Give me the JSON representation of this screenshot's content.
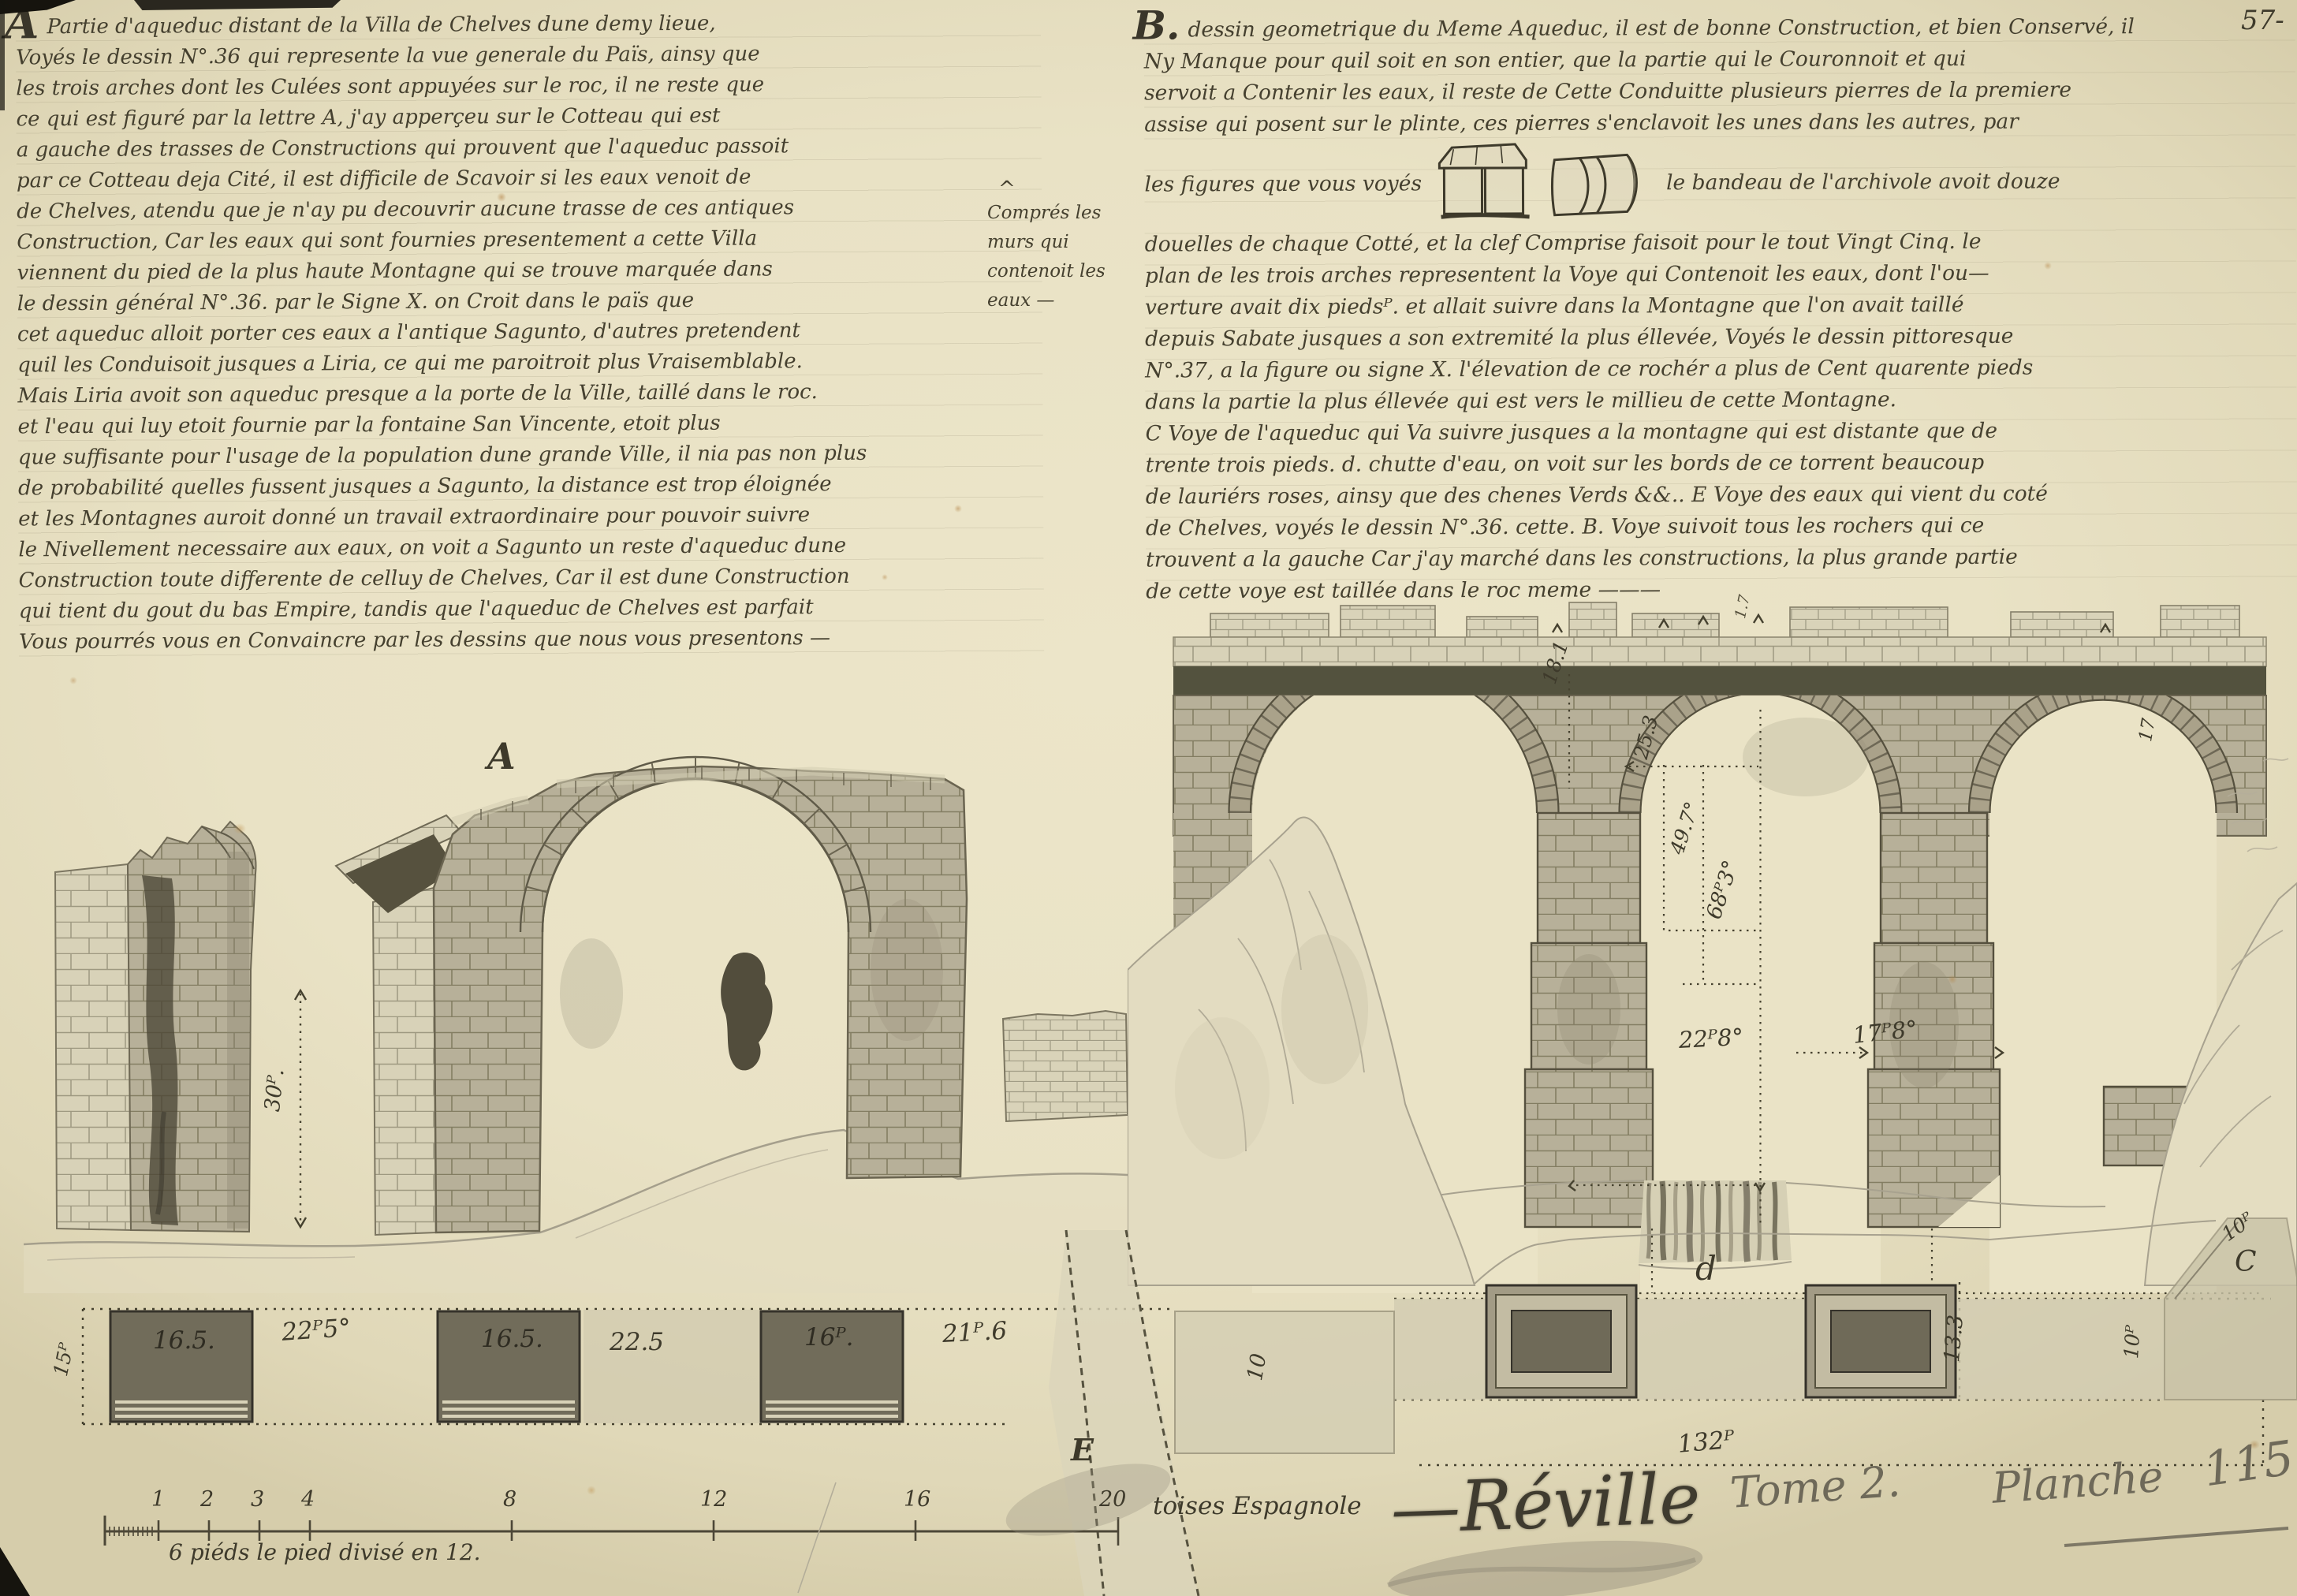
{
  "page": {
    "number": "57-"
  },
  "colors": {
    "paper": "#eae3c6",
    "ink": "#3e3a2b",
    "pencil": "#6e6959",
    "wash_light": "#d8d2b8",
    "wash_mid": "#b7b099",
    "wash_dark": "#53523e"
  },
  "left_text": {
    "initial": "A",
    "lines": [
      "Partie d'aqueduc distant de la Villa de Chelves dune demy lieue,",
      "Voyés le dessin N°.36 qui represente la vue generale du Païs, ainsy que",
      "les trois arches dont les Culées sont appuyées sur le roc, il ne reste que",
      "ce qui est figuré par la lettre A, j'ay apperçeu sur le Cotteau qui est",
      "a gauche des trasses de Constructions qui prouvent que l'aqueduc passoit",
      "par ce Cotteau deja Cité, il est difficile de Scavoir si les eaux venoit de",
      "de Chelves, atendu que je n'ay pu decouvrir aucune trasse de ces antiques",
      "Construction, Car les eaux qui sont fournies presentement a cette Villa",
      "viennent du pied de la plus haute Montagne qui se trouve marquée dans",
      "le dessin général N°.36. par le Signe X. on Croit dans le païs que",
      "cet aqueduc alloit porter ces eaux a l'antique Sagunto, d'autres pretendent",
      "quil les Conduisoit jusques a Liria, ce qui me paroitroit plus Vraisemblable.",
      "Mais Liria avoit son aqueduc presque a la porte de la Ville, taillé dans le roc.",
      "et l'eau qui luy etoit fournie par la fontaine San Vincente, etoit plus",
      "que suffisante pour l'usage de la population dune grande Ville, il nia pas non plus",
      "de probabilité quelles fussent jusques a Sagunto, la distance est trop éloignée",
      "et les Montagnes auroit donné un travail extraordinaire pour pouvoir suivre",
      "le Nivellement necessaire aux eaux, on voit a Sagunto un reste d'aqueduc dune",
      "Construction toute differente de celluy de Chelves, Car il est dune Construction",
      "qui tient du gout du bas Empire, tandis que l'aqueduc de Chelves est parfait",
      "Vous pourrés vous en Convaincre par les dessins que nous vous presentons —"
    ]
  },
  "margin_note": {
    "caret": "^",
    "lines": [
      "Comprés les",
      "murs qui",
      "contenoit les",
      "eaux —"
    ]
  },
  "right_text": {
    "initial": "B.",
    "lines_before": [
      "dessin geometrique du Meme Aqueduc, il est de bonne Construction, et bien Conservé, il",
      "Ny Manque pour quil soit en son entier, que la partie qui le Couronnoit et qui",
      "servoit a Contenir les eaux, il reste de Cette Conduitte plusieurs pierres de la premiere",
      "assise qui posent sur le plinte, ces pierres s'enclavoit les unes dans les autres, par"
    ],
    "fig_prefix": "les figures que vous voyés",
    "fig_suffix": "le bandeau de l'archivole avoit douze",
    "lines_after": [
      "douelles de chaque Cotté, et la clef Comprise faisoit pour le tout Vingt Cinq. le",
      "plan de les trois arches representent la Voye qui Contenoit les eaux, dont l'ou—",
      "verture avait dix piedsᴾ. et allait suivre dans la Montagne que l'on avait taillé",
      "depuis Sabate jusques a son extremité la plus éllevée, Voyés le dessin pittoresque",
      "N°.37, a la figure ou signe X. l'élevation de ce rochér a plus de Cent quarente pieds",
      "dans la partie la plus éllevée qui est vers le millieu de cette Montagne.",
      "C Voye de l'aqueduc qui Va suivre jusques a la montagne qui est distante que de",
      "trente trois pieds.  d. chutte d'eau, on voit sur les bords de ce torrent beaucoup",
      "de lauriérs roses, ainsy que des chenes Verds &&.. E Voye des eaux qui vient du coté",
      "de Chelves, voyés le dessin N°.36. cette.  B.  Voye suivoit tous les rochers qui ce",
      "trouvent a la gauche Car j'ay marché dans les constructions, la plus grande partie",
      "de cette voye est taillée dans le roc meme ———"
    ]
  },
  "drawing_a": {
    "label": "A",
    "dim_height": "30ᴾ."
  },
  "drawing_b": {
    "dim_18_1": "18.1",
    "dim_1_7": "1.7",
    "dim_25_3": "25.3",
    "dim_49_7": "49.7°",
    "dim_68_3": "68ᴾ3°",
    "dim_17": "17",
    "dim_22_8": "22ᴾ8°",
    "dim_17_8": "17ᴾ8°",
    "label_d": "d"
  },
  "plan": {
    "dim_15": "15ᴾ",
    "pier1": "16.5.",
    "gap1": "22ᴾ5°",
    "pier2": "16.5.",
    "gap2": "22.5",
    "pier3": "16ᴾ.",
    "gap3": "21ᴾ.6",
    "label_e": "E",
    "dim_10": "10",
    "dim_13_3": "13.3",
    "dim_132": "132ᴾ",
    "dim_10p_a": "10ᴾ",
    "dim_10p_b": "10ᴾ",
    "label_c": "C"
  },
  "scale_bar": {
    "ticks": [
      "1",
      "2",
      "3",
      "4",
      "8",
      "12",
      "16",
      "20"
    ],
    "unit_label": "toises Espagnole",
    "caption": "6 piéds le pied divisé en 12."
  },
  "footer": {
    "signature": "—Réville",
    "tome": "Tome 2.",
    "planche": "Planche",
    "plate_number": "115"
  }
}
